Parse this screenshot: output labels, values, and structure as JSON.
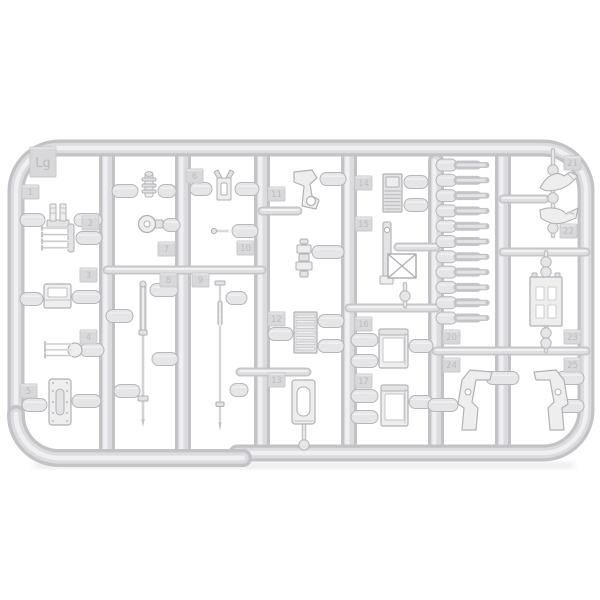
{
  "meta": {
    "title": "Light grey injection-molded plastic model kit sprue (runner frame) with many small parts, photographed on a white background",
    "background": "#ffffff"
  },
  "palette": {
    "tube_edge": "#c3c3c7",
    "tube_mid": "#dcdcdf",
    "tube_hi": "#f0f0f2",
    "bar_edge": "#c6c6c9",
    "bar_mid": "#dfdfe2",
    "bar_hi": "#f1f1f3",
    "pill_fill": "#e6e6e8",
    "pill_stroke": "#b7b7bb",
    "part_fill": "#e3e3e5",
    "part_fill_lt": "#eeeeef",
    "part_stroke": "#b2b2b6",
    "detail": "#c4c4c8",
    "white": "#ffffff",
    "tab_fill": "#d8d8db",
    "tab_stroke": "#c9c9cc",
    "tab_text": "#bcbcc0",
    "shadow": "#9a9a9e"
  },
  "frame": {
    "left_x": 16,
    "top_y": 148,
    "right_x": 586,
    "corner_r": 43,
    "bottom_right_y": 453,
    "bottom_left_y": 458,
    "step_x": 243,
    "thickness": 17
  },
  "columns": [
    {
      "id": "runner-col-a",
      "x": 107,
      "y1": 150,
      "y2": 458
    },
    {
      "id": "runner-col-b",
      "x": 183,
      "y1": 150,
      "y2": 458
    },
    {
      "id": "runner-col-c",
      "x": 262,
      "y1": 150,
      "y2": 453
    },
    {
      "id": "runner-col-d",
      "x": 349,
      "y1": 150,
      "y2": 453
    },
    {
      "id": "runner-col-e",
      "x": 436,
      "y1": 161,
      "y2": 453
    },
    {
      "id": "runner-col-f",
      "x": 503,
      "y1": 150,
      "y2": 453
    }
  ],
  "bars": [
    {
      "x1": 107,
      "x2": 262,
      "y": 270
    },
    {
      "x1": 262,
      "x2": 298,
      "y": 211
    },
    {
      "x1": 240,
      "x2": 307,
      "y": 372
    },
    {
      "x1": 398,
      "x2": 436,
      "y": 247
    },
    {
      "x1": 349,
      "x2": 436,
      "y": 308
    },
    {
      "x1": 503,
      "x2": 545,
      "y": 199
    },
    {
      "x1": 503,
      "x2": 586,
      "y": 252
    },
    {
      "x1": 436,
      "x2": 586,
      "y": 351
    }
  ],
  "pills": [
    {
      "x": 20,
      "y": 220,
      "w": 25
    },
    {
      "x": 74,
      "y": 220,
      "w": 28
    },
    {
      "x": 112,
      "y": 191,
      "w": 26
    },
    {
      "x": 158,
      "y": 191,
      "w": 18
    },
    {
      "x": 190,
      "y": 189,
      "w": 22
    },
    {
      "x": 235,
      "y": 189,
      "w": 24
    },
    {
      "x": 320,
      "y": 179,
      "w": 26
    },
    {
      "x": 404,
      "y": 182,
      "w": 24
    },
    {
      "x": 404,
      "y": 205,
      "w": 24
    },
    {
      "x": 76,
      "y": 238,
      "w": 26
    },
    {
      "x": 163,
      "y": 225,
      "w": 17
    },
    {
      "x": 232,
      "y": 231,
      "w": 26
    },
    {
      "x": 312,
      "y": 252,
      "w": 32
    },
    {
      "x": 20,
      "y": 299,
      "w": 23
    },
    {
      "x": 72,
      "y": 297,
      "w": 29
    },
    {
      "x": 106,
      "y": 316,
      "w": 27
    },
    {
      "x": 150,
      "y": 290,
      "w": 28
    },
    {
      "x": 152,
      "y": 359,
      "w": 26
    },
    {
      "x": 114,
      "y": 391,
      "w": 26
    },
    {
      "x": 226,
      "y": 298,
      "w": 21
    },
    {
      "x": 230,
      "y": 390,
      "w": 18
    },
    {
      "x": 80,
      "y": 350,
      "w": 24
    },
    {
      "x": 22,
      "y": 405,
      "w": 25
    },
    {
      "x": 72,
      "y": 401,
      "w": 29
    },
    {
      "x": 268,
      "y": 334,
      "w": 25
    },
    {
      "x": 318,
      "y": 321,
      "w": 26
    },
    {
      "x": 318,
      "y": 346,
      "w": 26
    },
    {
      "x": 351,
      "y": 340,
      "w": 27
    },
    {
      "x": 351,
      "y": 361,
      "w": 27
    },
    {
      "x": 409,
      "y": 346,
      "w": 24
    },
    {
      "x": 351,
      "y": 396,
      "w": 27
    },
    {
      "x": 351,
      "y": 417,
      "w": 27
    },
    {
      "x": 409,
      "y": 402,
      "w": 24
    },
    {
      "x": 486,
      "y": 378,
      "w": 33
    },
    {
      "x": 428,
      "y": 405,
      "w": 30
    },
    {
      "x": 556,
      "y": 378,
      "w": 28
    },
    {
      "x": 556,
      "y": 406,
      "w": 28
    }
  ],
  "vgates": [
    {
      "x": 553,
      "y1": 150,
      "y2": 236,
      "balls": [
        170,
        198,
        228
      ]
    },
    {
      "x": 546,
      "y1": 252,
      "y2": 279,
      "balls": [
        262,
        272
      ]
    },
    {
      "x": 546,
      "y1": 324,
      "y2": 351,
      "balls": [
        333,
        343
      ]
    },
    {
      "x": 304,
      "y1": 424,
      "y2": 444,
      "balls": [
        445
      ]
    },
    {
      "x": 405,
      "y1": 284,
      "y2": 306,
      "balls": [
        296
      ]
    }
  ],
  "comb": {
    "pill_x": 436,
    "tooth_x1": 458,
    "tooth_x2": 487,
    "y0": 165,
    "dy": 15.3,
    "rows": 11
  },
  "parts": [
    {
      "id": "shackle-pair",
      "type": "clampset",
      "x": 47,
      "y": 204
    },
    {
      "id": "pump-cylinder",
      "type": "cylinder",
      "x": 141,
      "y": 171
    },
    {
      "id": "clamp-horn",
      "type": "horn",
      "x": 215,
      "y": 170
    },
    {
      "id": "light-bracket",
      "type": "bracket",
      "x": 292,
      "y": 170
    },
    {
      "id": "radiator-grille",
      "type": "grille",
      "x": 383,
      "y": 174
    },
    {
      "id": "tow-hook-a",
      "type": "hooka",
      "x": 540,
      "y": 172
    },
    {
      "id": "tow-hook-b",
      "type": "hookb",
      "x": 540,
      "y": 204
    },
    {
      "id": "fork-4prong",
      "type": "fork4",
      "x": 42,
      "y": 224
    },
    {
      "id": "wheel-knob",
      "type": "wheel",
      "x": 138,
      "y": 215
    },
    {
      "id": "small-pin",
      "type": "pin",
      "x": 212,
      "y": 226
    },
    {
      "id": "periscope-stack",
      "type": "stack",
      "x": 296,
      "y": 239
    },
    {
      "id": "stowage-box",
      "type": "boxsmall",
      "x": 44,
      "y": 284
    },
    {
      "id": "ribbed-rod",
      "type": "rodribbed",
      "x": 143,
      "y1": 282,
      "y2": 427
    },
    {
      "id": "plain-rod",
      "type": "rodplain",
      "x": 220,
      "y1": 281,
      "y2": 430
    },
    {
      "id": "fork-3prong",
      "type": "fork3",
      "x": 45,
      "y": 342
    },
    {
      "id": "riveted-plate",
      "type": "rivetplate",
      "x": 49,
      "y": 379
    },
    {
      "id": "track-pad",
      "type": "ladderpad",
      "x": 294,
      "y": 312
    },
    {
      "id": "hatch-door",
      "type": "doorplate",
      "x": 292,
      "y": 380
    },
    {
      "id": "bin-upper",
      "type": "bin",
      "x": 379,
      "y": 329,
      "w": 29,
      "h": 39
    },
    {
      "id": "bin-lower",
      "type": "bin",
      "x": 381,
      "y": 385,
      "w": 27,
      "h": 41
    },
    {
      "id": "jack-strip",
      "type": "strip",
      "x": 380,
      "y": 222
    },
    {
      "id": "x-frame",
      "type": "xframe",
      "x": 388,
      "y": 254,
      "w": 28,
      "h": 24
    },
    {
      "id": "hole-plate",
      "type": "holeplate",
      "x": 530,
      "y": 277
    },
    {
      "id": "lever-left",
      "type": "leverL",
      "x": 455,
      "y": 368
    },
    {
      "id": "lever-right",
      "type": "leverR",
      "x": 528,
      "y": 368
    }
  ],
  "tabs": [
    {
      "label": "Lg",
      "x": 30,
      "y": 147,
      "w": 26,
      "h": 30,
      "big": true
    },
    {
      "label": "1",
      "x": 22,
      "y": 185
    },
    {
      "label": "2",
      "x": 82,
      "y": 216
    },
    {
      "label": "3",
      "x": 80,
      "y": 268
    },
    {
      "label": "4",
      "x": 80,
      "y": 330
    },
    {
      "label": "5",
      "x": 20,
      "y": 384
    },
    {
      "label": "6",
      "x": 186,
      "y": 169
    },
    {
      "label": "7",
      "x": 158,
      "y": 242
    },
    {
      "label": "8",
      "x": 160,
      "y": 273
    },
    {
      "label": "9",
      "x": 192,
      "y": 273
    },
    {
      "label": "10",
      "x": 237,
      "y": 241
    },
    {
      "label": "11",
      "x": 268,
      "y": 187
    },
    {
      "label": "12",
      "x": 268,
      "y": 312
    },
    {
      "label": "13",
      "x": 268,
      "y": 373
    },
    {
      "label": "14",
      "x": 355,
      "y": 176
    },
    {
      "label": "15",
      "x": 355,
      "y": 217
    },
    {
      "label": "16",
      "x": 355,
      "y": 317
    },
    {
      "label": "17",
      "x": 355,
      "y": 374
    },
    {
      "label": "20",
      "x": 443,
      "y": 330
    },
    {
      "label": "21",
      "x": 564,
      "y": 156
    },
    {
      "label": "22",
      "x": 560,
      "y": 224
    },
    {
      "label": "23",
      "x": 564,
      "y": 330
    },
    {
      "label": "24",
      "x": 443,
      "y": 358
    },
    {
      "label": "25",
      "x": 564,
      "y": 358
    }
  ]
}
